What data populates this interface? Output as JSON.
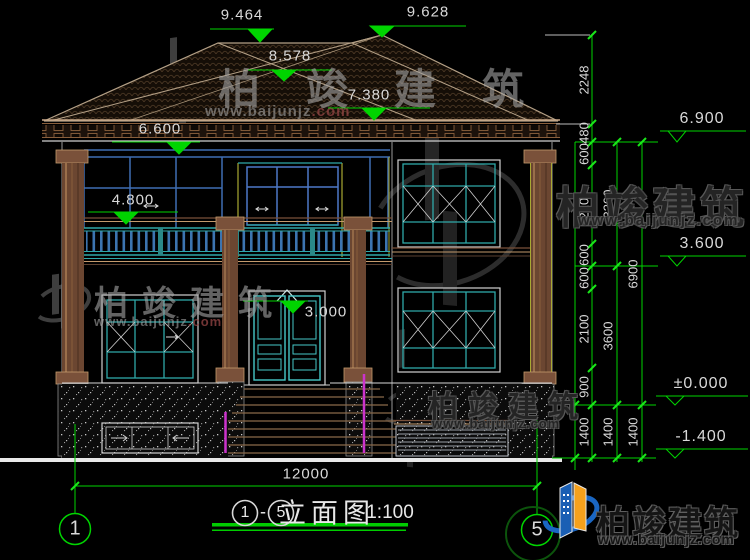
{
  "drawing": {
    "top_levels": {
      "ridge_left": "9.464",
      "ridge_right": "9.628",
      "mid_roof": "8.578",
      "eave_right": "7.380",
      "eave_left": "6.600",
      "balcony": "4.800",
      "door": "3.000"
    },
    "right_levels": {
      "l1": "6.900",
      "l2": "3.600",
      "l3": "±0.000",
      "l4": "-1.400"
    },
    "chain_a": [
      "2248",
      "480",
      "600",
      "2100",
      "600",
      "600",
      "2100",
      "900",
      "1400"
    ],
    "chain_b": [
      "3300",
      "3600",
      "1400"
    ],
    "chain_c": [
      "6900",
      "1400"
    ],
    "bottom_dim": {
      "total": "12000"
    },
    "axes": {
      "left": "1",
      "right": "5"
    },
    "title": {
      "axis_from": "1",
      "dash": "-",
      "axis_to": "5",
      "name": "立面图",
      "scale": "1:100"
    }
  },
  "watermark": {
    "brand": "柏竣建筑",
    "url_main": "www.baijunjz",
    "url_tail": ".com",
    "url_full": "www.baijunjz.com"
  },
  "logo": {
    "brand": "柏竣建筑",
    "url": "www.baijunjz.com"
  },
  "colors": {
    "dim_green": "#00d400",
    "cad_white": "#d9d9d9",
    "teal": "#2fa8a8",
    "steel_blue": "#3f6db3",
    "brown": "#7a513a",
    "tan": "#c49a6c",
    "yellow": "#a8a832",
    "magenta": "#cc33cc",
    "logo_blue": "#1a66c2",
    "logo_orange": "#f5a11c"
  }
}
